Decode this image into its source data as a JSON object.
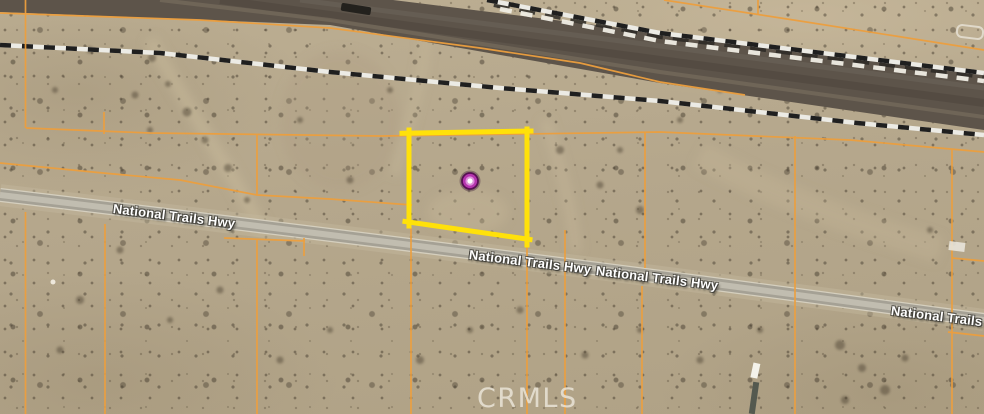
{
  "map": {
    "watermark": "CRMLS",
    "road_name": "National Trails Hwy",
    "road_labels": [
      "National Trails Hwy",
      "National Trails Hwy",
      "National Trails Hwy",
      "National Trails Hwy"
    ],
    "marker": {
      "type": "property-location-pin",
      "x": 470,
      "y": 181
    },
    "highlight_parcel_corners": [
      [
        409,
        133
      ],
      [
        527,
        131
      ],
      [
        527,
        239
      ],
      [
        410,
        222
      ]
    ],
    "colors": {
      "parcel_line": "#ED9F3E",
      "highlight_parcel": "#FFE10A",
      "marker_ring": "#B535AE",
      "marker_ring_edge": "#571053",
      "marker_center": "#FFFFFF",
      "desert_base": "#B5A78C",
      "railroad_bed": "#5D544A",
      "railroad_dash_dark": "#1F1F1F",
      "railroad_dash_light": "#ECEBE5",
      "road_surface": "#A5A195",
      "watermark_color": "#ECE7DB"
    }
  }
}
